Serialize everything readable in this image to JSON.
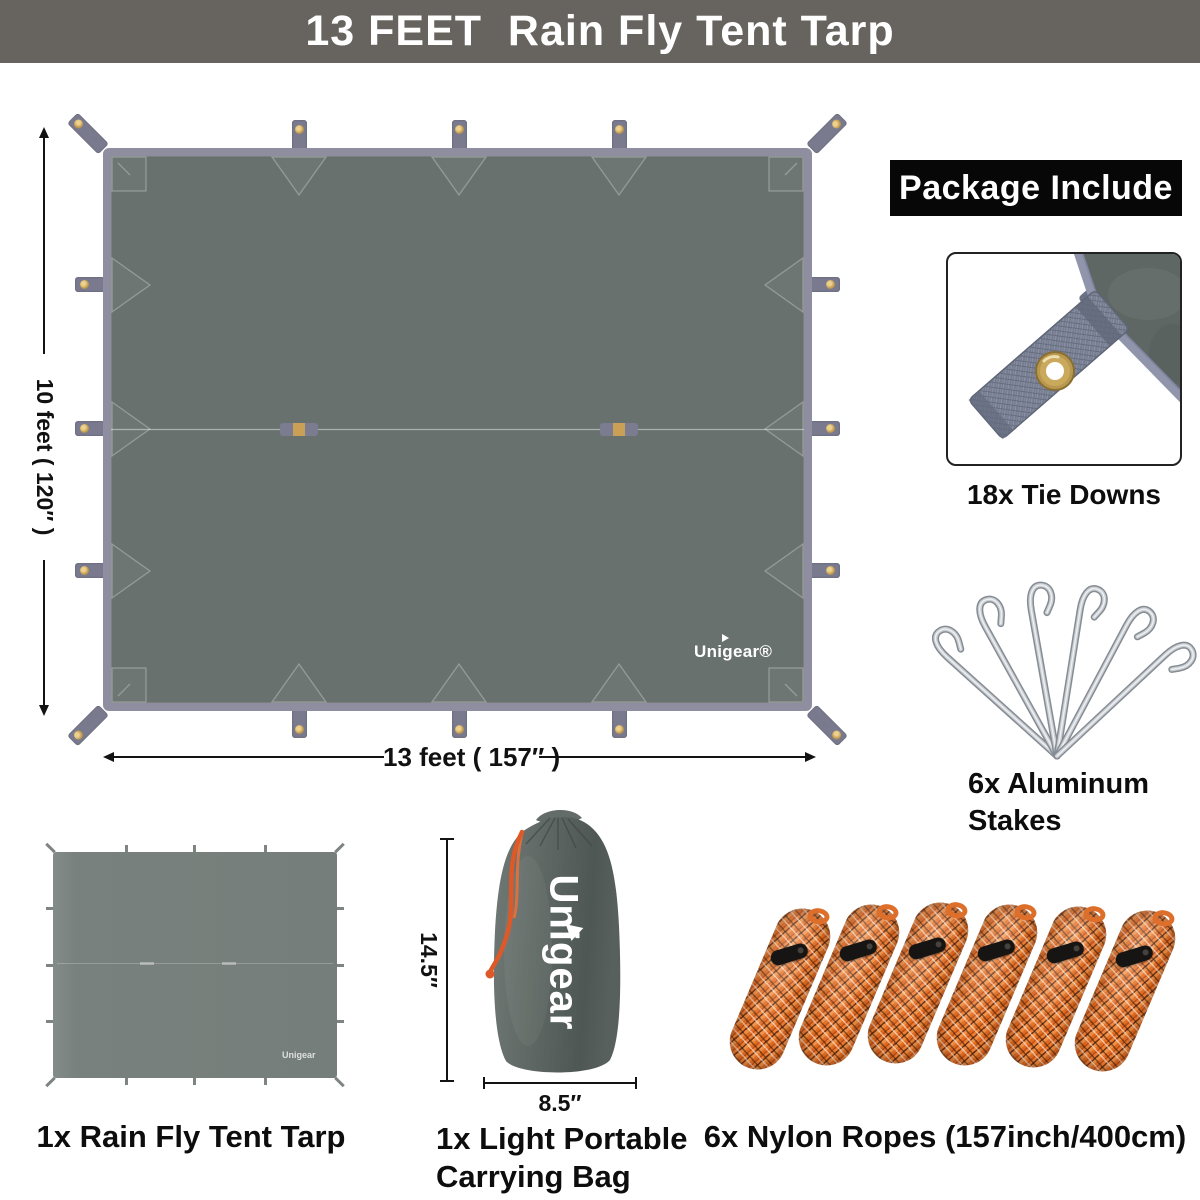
{
  "banner": {
    "title": "13 FEET  Rain Fly Tent Tarp"
  },
  "diagram": {
    "height_label": "10 feet ( 120″ )",
    "width_label": "13 feet ( 157″ )",
    "brand": "Unigear®"
  },
  "package": {
    "header": "Package Include",
    "tie_downs": {
      "label": "18x Tie Downs"
    },
    "stakes": {
      "label": "6x Aluminum Stakes"
    },
    "tarp": {
      "label": "1x Rain Fly Tent Tarp",
      "mini_brand": "Unigear"
    },
    "bag": {
      "label": "1x Light Portable Carrying Bag",
      "brand": "Unigear",
      "height_label": "14.5″",
      "width_label": "8.5″"
    },
    "ropes": {
      "label": "6x Nylon Ropes (157inch/400cm)"
    }
  },
  "colors": {
    "banner_bg": "#67635f",
    "tarp_fill": "#69716e",
    "tarp_border": "#8e8ea0",
    "tab": "#7a7a8f",
    "grommet": "#c9a158",
    "rope_orange": "#e26d22",
    "label_text": "#111111"
  }
}
